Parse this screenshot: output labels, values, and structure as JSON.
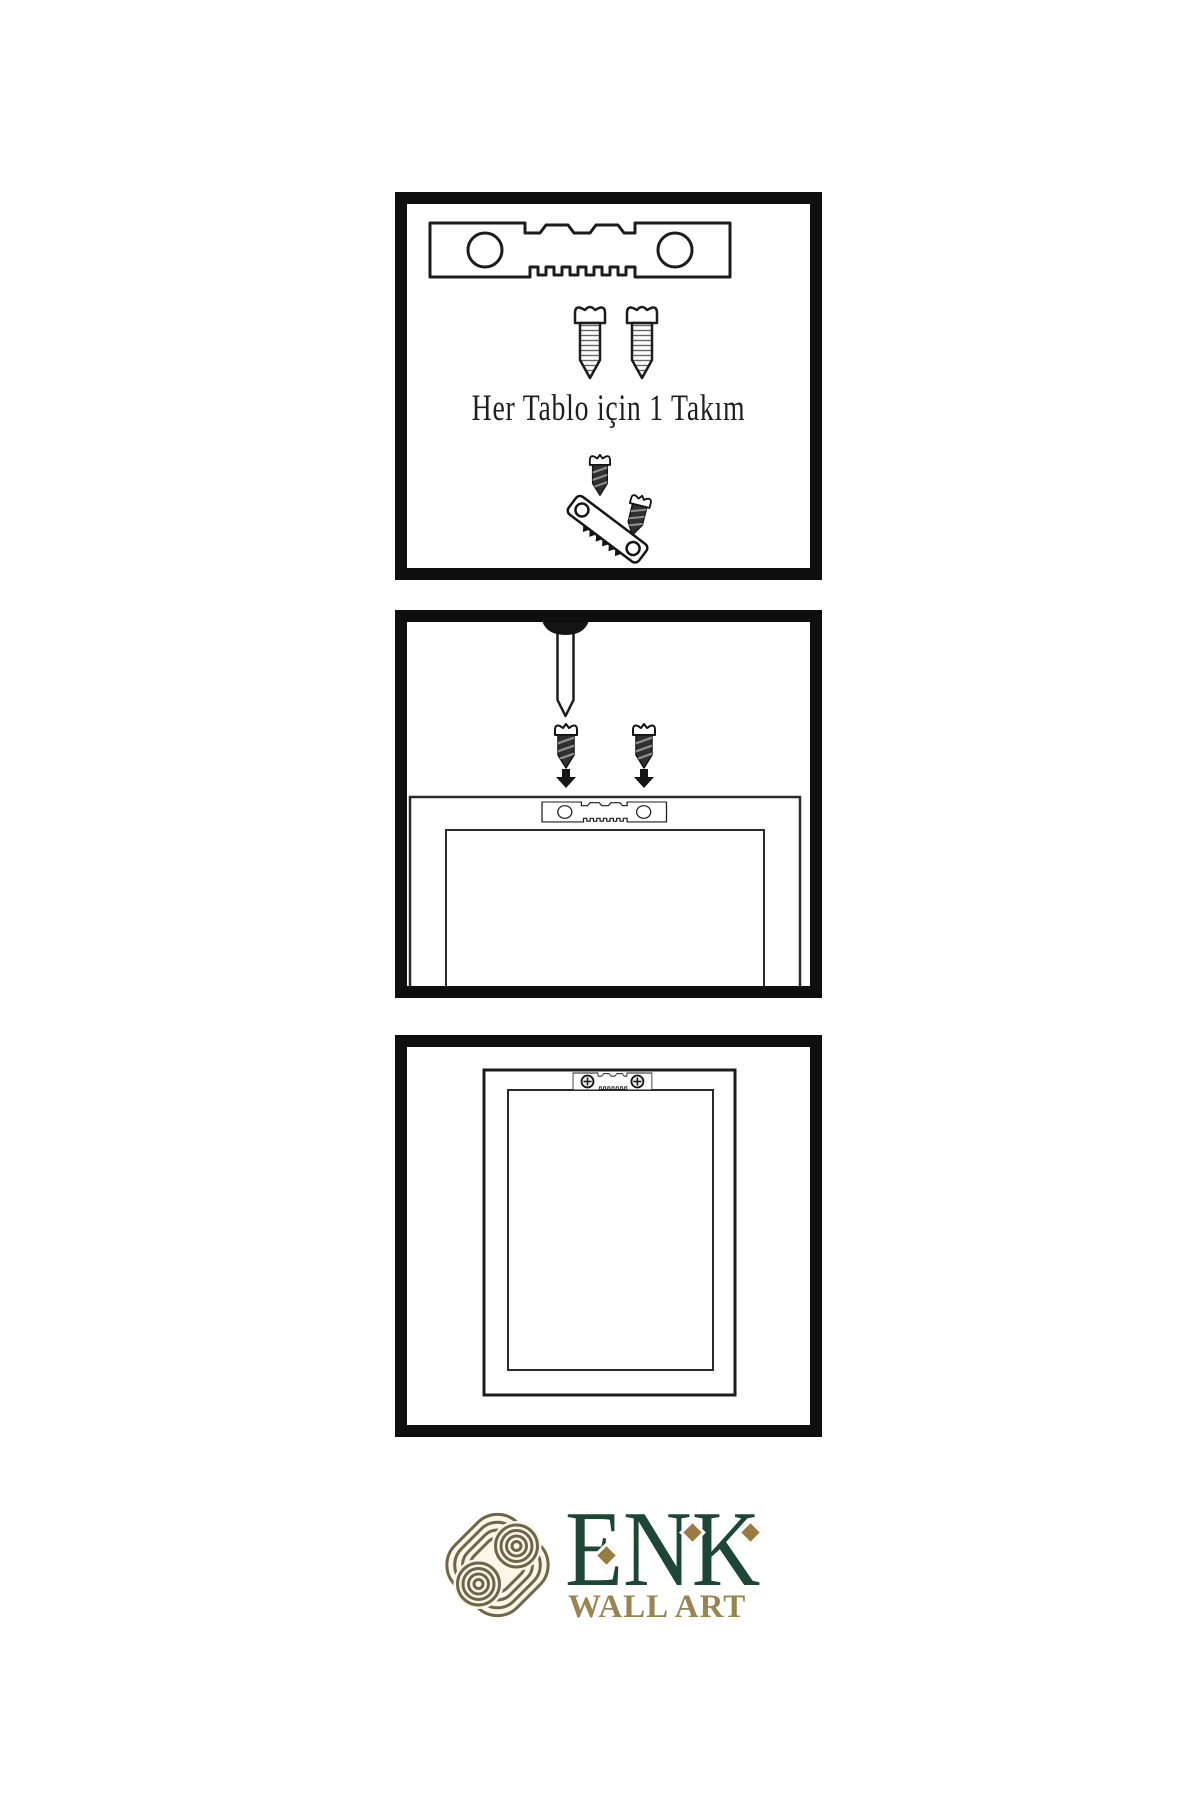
{
  "document": {
    "type": "wall-art-hanging-instruction-sheet",
    "background": "#ffffff",
    "ink": "#1a1a1a"
  },
  "panels": [
    {
      "id": "hardware-kit",
      "caption": "Her Tablo için 1 Takım",
      "items": [
        "sawtooth-hanger-icon",
        "screw-icon",
        "screw-icon",
        "screw-into-hanger-assembly-icon"
      ]
    },
    {
      "id": "wall-mounting",
      "items": [
        "wall-nail-icon",
        "dark-screw-icon",
        "dark-screw-icon",
        "down-arrow-icon",
        "down-arrow-icon",
        "sawtooth-hanger-icon",
        "frame-back-outline"
      ]
    },
    {
      "id": "hung-frame",
      "items": [
        "framed-picture-outline",
        "sawtooth-hanger-with-screws-icon"
      ]
    }
  ],
  "logo": {
    "name": "ENK",
    "subtitle": "WALL ART",
    "icon": "interlocking-knot-icon"
  },
  "colors": {
    "brand_green": "#1d4637",
    "brand_gold": "#9a7b41",
    "subtitle_gold": "#9b8352",
    "knot_olive": "#6e6647",
    "knot_fill": "#faf6ea",
    "ink": "#1a1a1a",
    "background": "#ffffff"
  }
}
